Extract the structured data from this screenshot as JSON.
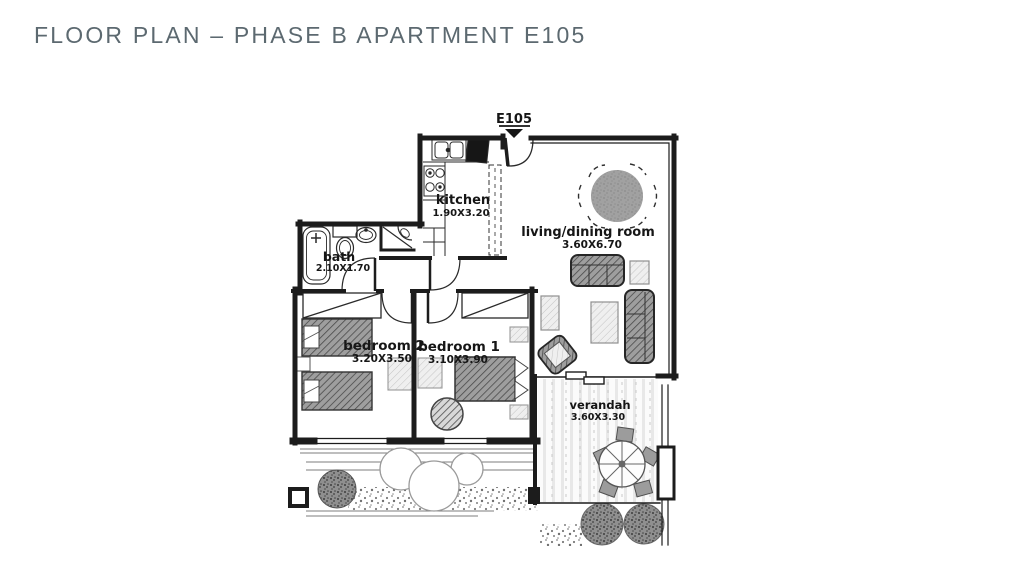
{
  "header": {
    "title": "FLOOR PLAN – PHASE B APARTMENT E105"
  },
  "plan": {
    "unit_label": "E105",
    "rooms": [
      {
        "id": "kitchen",
        "name": "kitchen",
        "dims": "1.90X3.20"
      },
      {
        "id": "living_dining",
        "name": "living/dining room",
        "dims": "3.60X6.70"
      },
      {
        "id": "bath",
        "name": "bath",
        "dims": "2.10X1.70"
      },
      {
        "id": "bedroom2",
        "name": "bedroom 2",
        "dims": "3.20X3.50"
      },
      {
        "id": "bedroom1",
        "name": "bedroom 1",
        "dims": "3.10X3.90"
      },
      {
        "id": "verandah",
        "name": "verandah",
        "dims": "3.60X3.30"
      }
    ]
  },
  "colors": {
    "title_text": "#5c6970",
    "wall_ink": "#1c1c1c",
    "furniture_dark": "#9e9e9e",
    "furniture_light": "#efefef",
    "paper": "#ffffff"
  }
}
